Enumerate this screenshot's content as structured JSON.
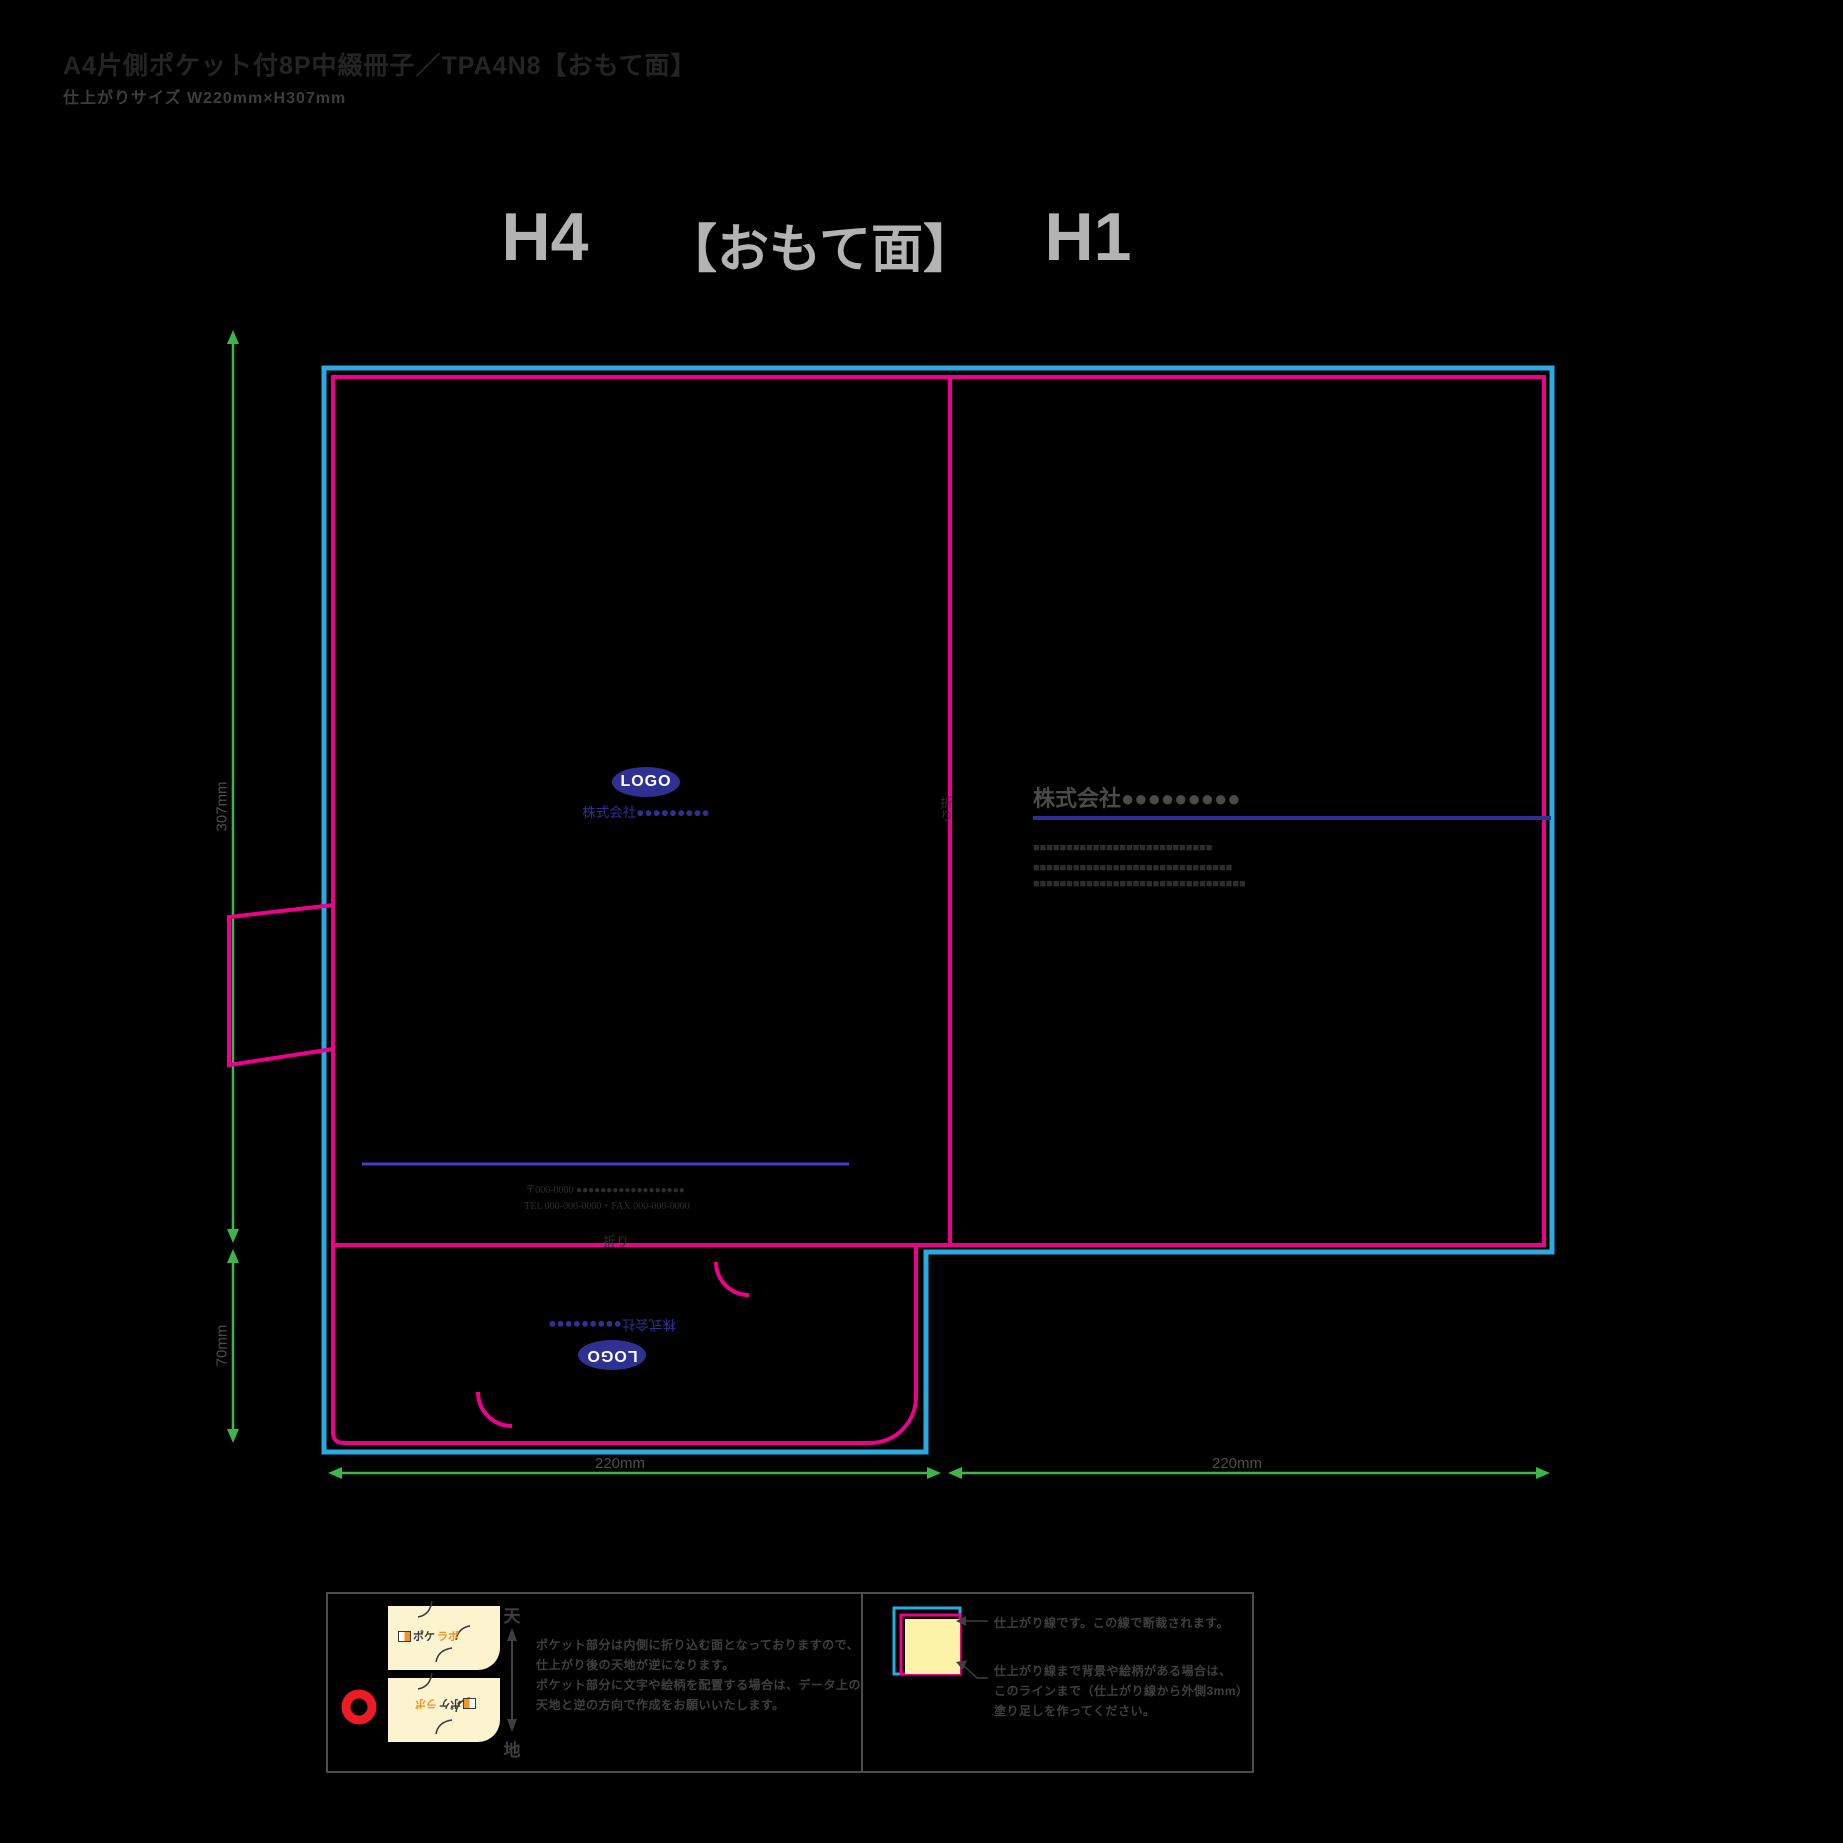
{
  "page": {
    "title": "A4片側ポケット付8P中綴冊子／TPA4N8【おもて面】",
    "subtitle": "仕上がりサイズ W220mm×H307mm"
  },
  "header": {
    "back_cover": "H4",
    "side": "【おもて面】",
    "front_cover": "H1"
  },
  "dimensions": {
    "page_height": "307mm",
    "pocket_height": "70mm",
    "back_width": "220mm",
    "front_width": "220mm"
  },
  "fold_label": "折り",
  "h4_panel": {
    "logo": "LOGO",
    "company": "株式会社●●●●●●●●●",
    "postal": "〒000-0000 ●●●●●●●●●●●●●●●●●●",
    "tel_fax": "TEL 000-000-0000・FAX 000-000-0000"
  },
  "h1_panel": {
    "company": "株式会社●●●●●●●●●",
    "body_line_1": "■■■■■■■■■■■■■■■■■■■■■■■■■■■",
    "body_line_2": "■■■■■■■■■■■■■■■■■■■■■■■■■■■■■■",
    "body_line_3": "■■■■■■■■■■■■■■■■■■■■■■■■■■■■■■■■"
  },
  "pocket": {
    "logo": "LOGO",
    "company": "株式会社●●●●●●●●●"
  },
  "legend_pocket": {
    "top": "天",
    "bottom": "地",
    "logo_prefix": "ポケ",
    "logo_suffix": "ラボ",
    "line_1": "ポケット部分は内側に折り込む面となっておりますので、",
    "line_2": "仕上がり後の天地が逆になります。",
    "line_3": "ポケット部分に文字や絵柄を配置する場合は、データ上の",
    "line_4": "天地と逆の方向で作成をお願いいたします。"
  },
  "legend_trim": {
    "line_1": "仕上がり線です。この線で断裁されます。",
    "line_2": "仕上がり線まで背景や絵柄がある場合は、",
    "line_3": "このラインまで（仕上がり線から外側3mm）",
    "line_4": "塗り足しを作ってください。"
  },
  "colors": {
    "bleed_line_cyan": "#29abe2",
    "trim_line_magenta": "#ec008c",
    "dimension_green": "#3cb54a",
    "brand_blue": "#2e3192",
    "rule_blue": "#3d3dd0",
    "header_gray": "#b3b3b3",
    "label_gray": "#4d4d4d",
    "legend_cream": "#fcf3cf",
    "logo_accent_orange": "#f7931e",
    "alert_red": "#ed1c24"
  }
}
